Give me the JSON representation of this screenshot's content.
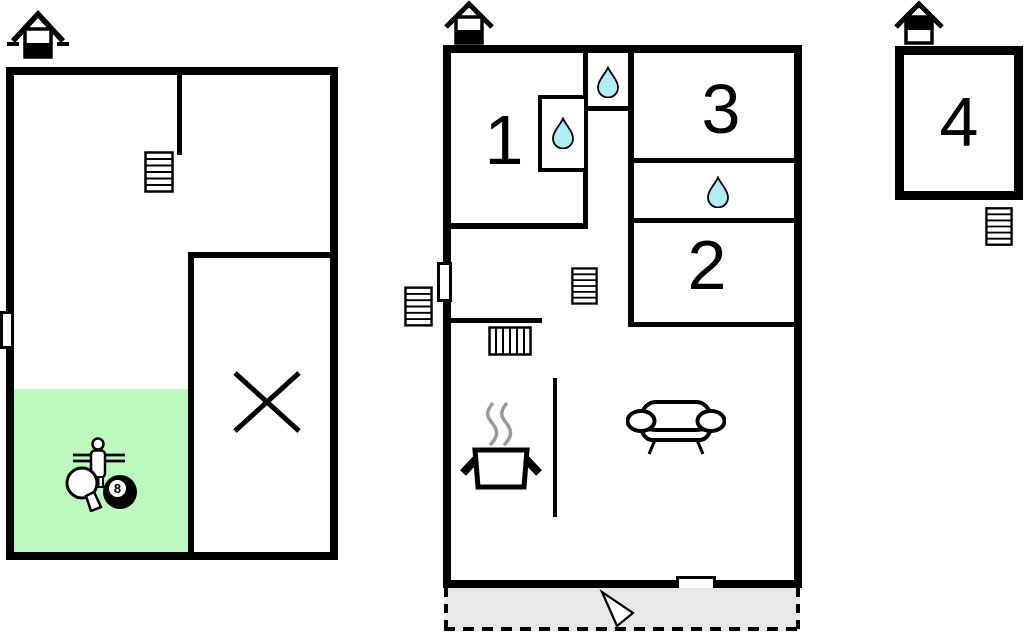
{
  "title": "Holiday home floor plan",
  "colors": {
    "wall": "#000000",
    "game_area": "#bcf9bf",
    "water": "#b2ecf5",
    "terrace": "#e8e8e8",
    "steam": "#999999",
    "paper": "#ffffff"
  },
  "rooms": {
    "room1": {
      "label": "1"
    },
    "room2": {
      "label": "2"
    },
    "room3": {
      "label": "3"
    },
    "room4": {
      "label": "4"
    }
  },
  "icons": {
    "eight_ball_label": "8",
    "house_level_basement": "house-glyph-lower-filled-with-ground-dashes",
    "house_level_ground": "house-glyph-lower-filled",
    "house_level_upper": "house-glyph-upper-filled",
    "stairs": "striped-rectangle",
    "water_drop": "teardrop",
    "kitchen_pot": "pot-with-steam",
    "sofa": "sofa-outline",
    "foosball_player": "figure-on-rods",
    "table_tennis_paddle": "paddle-outline",
    "eight_ball": "black-ball-8",
    "entrance_arrow": "white-triangle-arrow",
    "no_access": "x-mark",
    "door": "white-rect-marker",
    "window": "white-rect-marker"
  }
}
